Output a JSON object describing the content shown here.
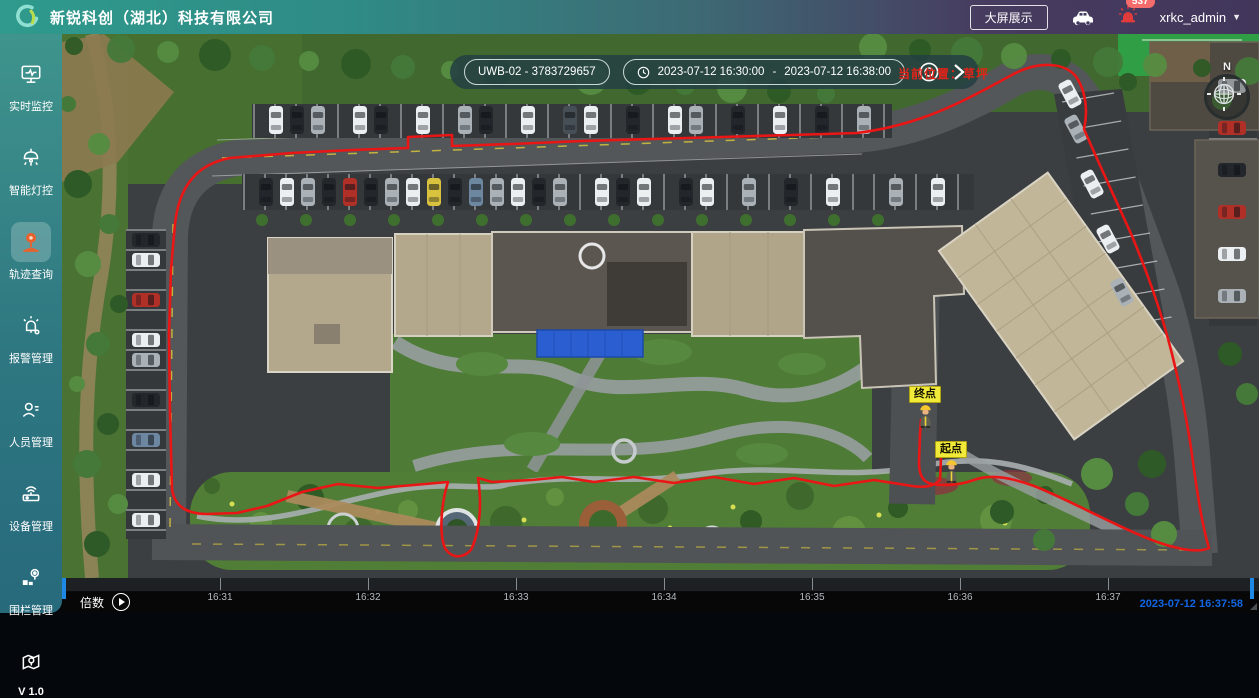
{
  "header": {
    "title": "新锐科创（湖北）科技有限公司",
    "big_screen_label": "大屏展示",
    "notification_count": "537",
    "username": "xrkc_admin"
  },
  "sidebar": {
    "items": [
      {
        "label": "实时监控"
      },
      {
        "label": "智能灯控"
      },
      {
        "label": "轨迹查询"
      },
      {
        "label": "报警管理"
      },
      {
        "label": "人员管理"
      },
      {
        "label": "设备管理"
      },
      {
        "label": "围栏管理"
      },
      {
        "label": ""
      }
    ],
    "active_item": "轨迹查询",
    "version": "V 1.0"
  },
  "map": {
    "toolbar": {
      "device": "UWB-02 - 3783729657",
      "time_start": "2023-07-12 16:30:00",
      "time_separator": "-",
      "time_end": "2023-07-12 16:38:00"
    },
    "position_text": "当前位置：草坪",
    "compass_north": "N",
    "markers": {
      "end": "终点",
      "start": "起点"
    }
  },
  "timeline": {
    "speed_label": "倍数",
    "ticks": [
      "16:31",
      "16:32",
      "16:33",
      "16:34",
      "16:35",
      "16:36",
      "16:37"
    ],
    "current_time": "2023-07-12 16:37:58"
  },
  "colors": {
    "header_teal": "#2f9a8d",
    "header_purple": "#42365b",
    "active_icon_orange": "#e8622d",
    "badge_red": "#f56c6c",
    "trajectory_red": "#ea1515",
    "marker_yellow": "#f2ea39",
    "playhead_blue": "#1e88e5",
    "timestamp_blue": "#1266e3"
  }
}
